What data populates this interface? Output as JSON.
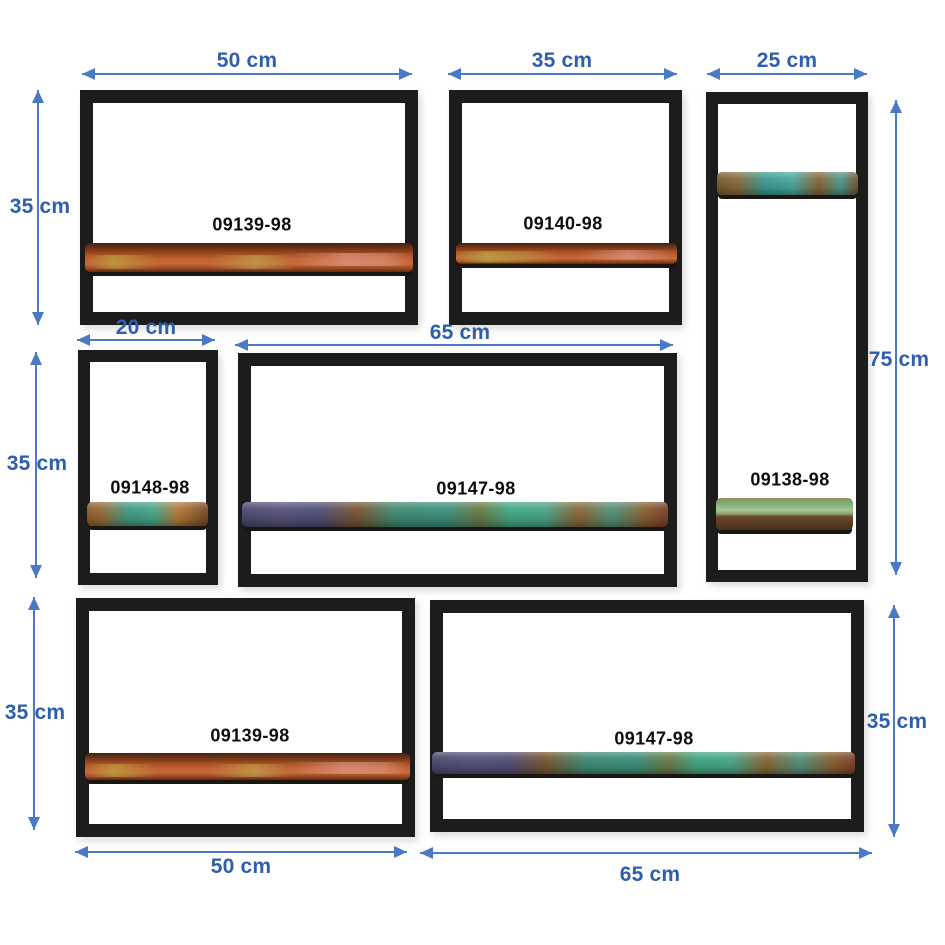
{
  "diagram": {
    "type": "wall-shelf-set-dimension-diagram",
    "background": "#ffffff",
    "dimension_text_color": "#2e5fac",
    "arrow_color": "#4b79c6",
    "frame_color": "#1c1c1c",
    "plank_copper_color": "#c05f2e",
    "plank_patina_color": "#3fa884"
  },
  "shelves": [
    {
      "code": "09139-98",
      "position": "top-left",
      "width_label": "50 cm",
      "height_label": "35 cm",
      "width_cm": 50,
      "height_cm": 35
    },
    {
      "code": "09140-98",
      "position": "top-center",
      "width_label": "35 cm",
      "width_cm": 35
    },
    {
      "code": "09138-98",
      "position": "top-right-tall",
      "width_label": "25 cm",
      "height_label": "75 cm",
      "width_cm": 25,
      "height_cm": 75
    },
    {
      "code": "09148-98",
      "position": "middle-left",
      "width_label": "20 cm",
      "height_label": "35 cm",
      "width_cm": 20,
      "height_cm": 35
    },
    {
      "code": "09147-98",
      "position": "middle-center",
      "width_label": "65 cm",
      "width_cm": 65
    },
    {
      "code": "09139-98",
      "position": "bottom-left",
      "width_label": "50 cm",
      "height_label": "35 cm",
      "width_cm": 50,
      "height_cm": 35
    },
    {
      "code": "09147-98",
      "position": "bottom-right",
      "width_label": "65 cm",
      "height_label": "35 cm",
      "width_cm": 65,
      "height_cm": 35
    }
  ],
  "dims": {
    "top_a": "50 cm",
    "top_b": "35 cm",
    "top_c": "25 cm",
    "left_row1": "35 cm",
    "left_row2": "35 cm",
    "left_row3": "35 cm",
    "right_tall": "75 cm",
    "right_bottom": "35 cm",
    "mid_d": "20 cm",
    "mid_e": "65 cm",
    "bottom_f": "50 cm",
    "bottom_g": "65 cm"
  }
}
